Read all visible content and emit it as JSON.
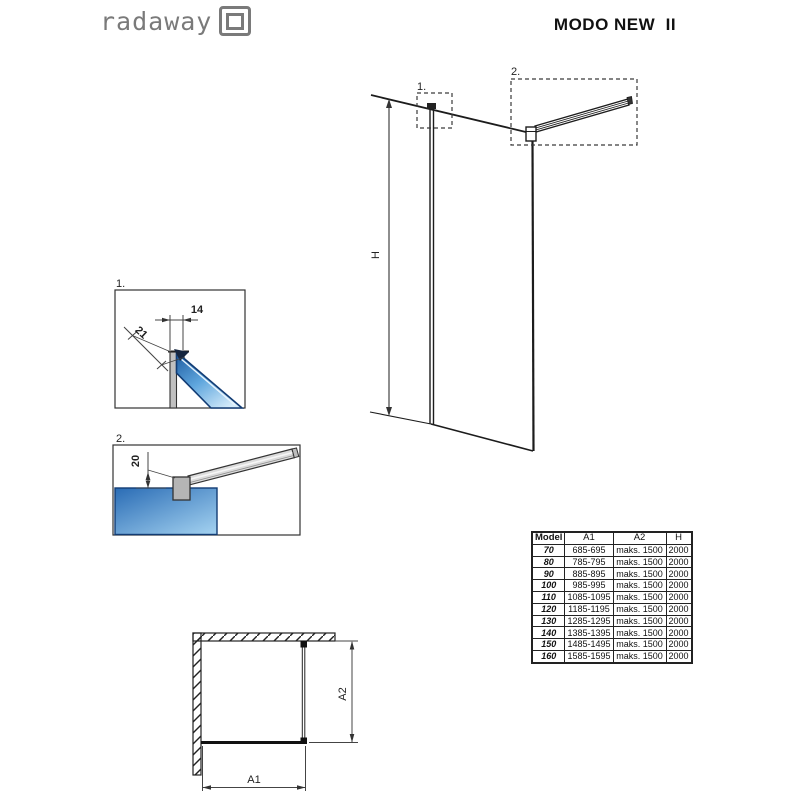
{
  "header": {
    "brand": "radaway",
    "title": "MODO NEW  II"
  },
  "elevation": {
    "detail1_label": "1.",
    "detail2_label": "2.",
    "height_dim": "H"
  },
  "detail1": {
    "label": "1.",
    "dim_top": "14",
    "dim_diagonal": "21"
  },
  "detail2": {
    "label": "2.",
    "dim_offset": "20"
  },
  "plan": {
    "dim_width": "A1",
    "dim_depth": "A2"
  },
  "table": {
    "headers": [
      "Model",
      "A1",
      "A2",
      "H"
    ],
    "rows": [
      {
        "model": "70",
        "a1": "685-695",
        "a2": "maks. 1500",
        "h": "2000"
      },
      {
        "model": "80",
        "a1": "785-795",
        "a2": "maks. 1500",
        "h": "2000"
      },
      {
        "model": "90",
        "a1": "885-895",
        "a2": "maks. 1500",
        "h": "2000"
      },
      {
        "model": "100",
        "a1": "985-995",
        "a2": "maks. 1500",
        "h": "2000"
      },
      {
        "model": "110",
        "a1": "1085-1095",
        "a2": "maks. 1500",
        "h": "2000"
      },
      {
        "model": "120",
        "a1": "1185-1195",
        "a2": "maks. 1500",
        "h": "2000"
      },
      {
        "model": "130",
        "a1": "1285-1295",
        "a2": "maks. 1500",
        "h": "2000"
      },
      {
        "model": "140",
        "a1": "1385-1395",
        "a2": "maks. 1500",
        "h": "2000"
      },
      {
        "model": "150",
        "a1": "1485-1495",
        "a2": "maks. 1500",
        "h": "2000"
      },
      {
        "model": "160",
        "a1": "1585-1595",
        "a2": "maks. 1500",
        "h": "2000"
      }
    ]
  },
  "colors": {
    "line": "#1c1c1c",
    "brand_gray": "#7a7a7a",
    "glass_dark": "#1c5aa0",
    "glass_light": "#d6ecfa",
    "profile_gray": "#c0c0c0"
  }
}
